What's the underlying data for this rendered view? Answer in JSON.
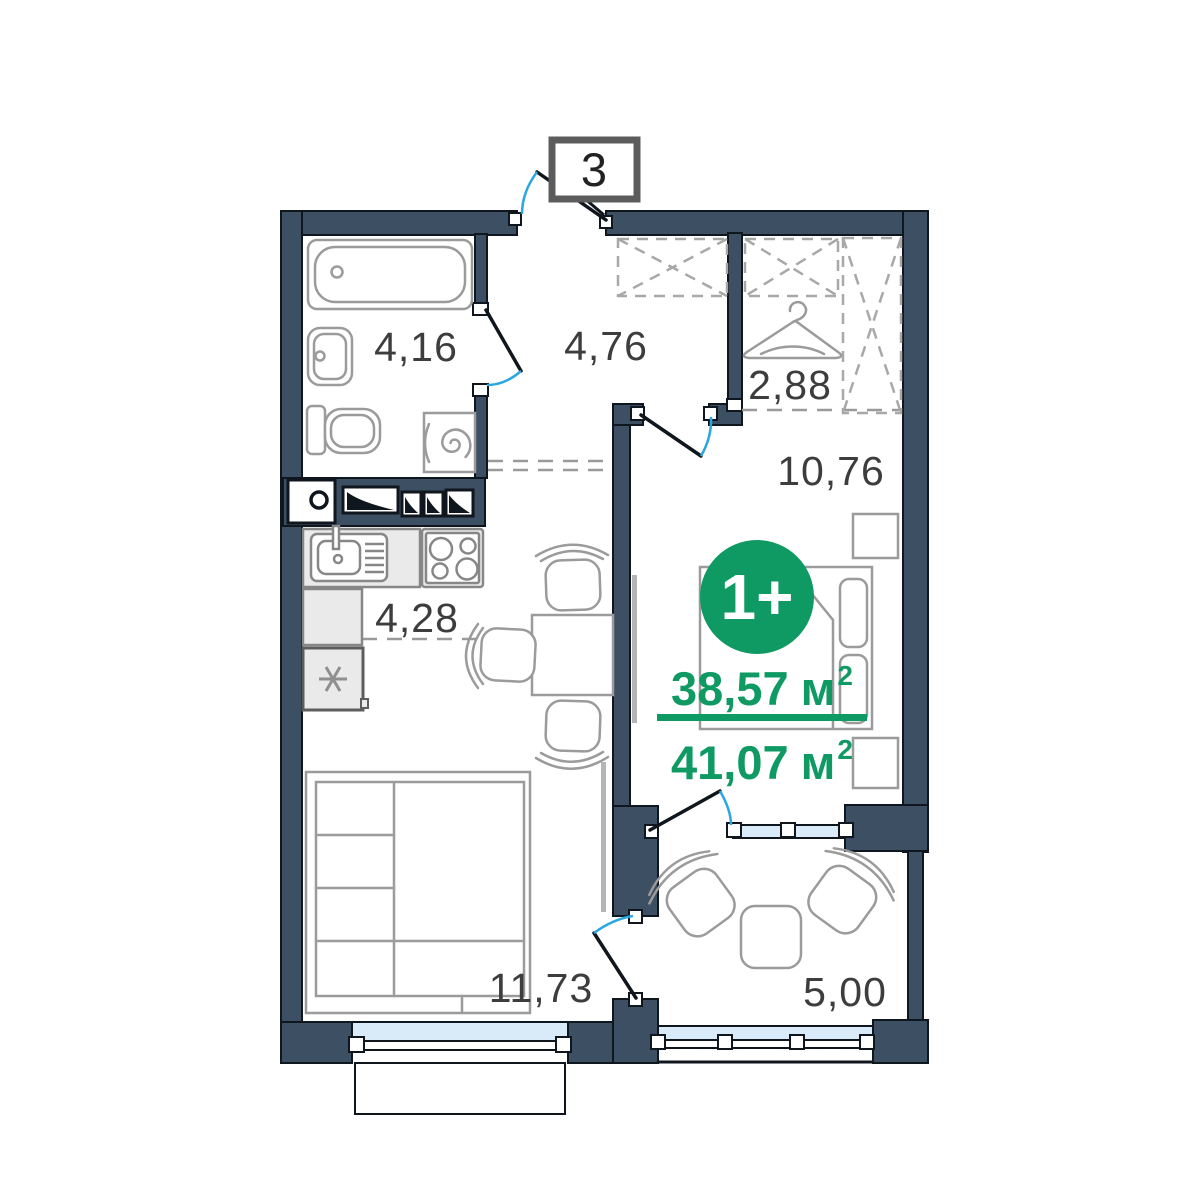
{
  "plan": {
    "entrance_label": "3",
    "type_badge": "1+",
    "area_main": "38,57",
    "area_total": "41,07",
    "area_unit": "м",
    "area_sup": "2",
    "rooms": {
      "bathroom": "4,16",
      "hallway": "4,76",
      "closet": "2,88",
      "bedroom": "10,76",
      "kitchen": "4,28",
      "living": "11,73",
      "balcony": "5,00"
    },
    "icons": [
      "bathtub",
      "bathroom-sink",
      "toilet",
      "washing-machine",
      "ventilation-shaft",
      "kitchen-sink",
      "stove",
      "fridge",
      "dining-table",
      "chair",
      "hanger",
      "wardrobe",
      "bed",
      "nightstand",
      "sofa",
      "armchair",
      "balcony-table",
      "window",
      "door-swing"
    ],
    "colors": {
      "wall": "#3d4f63",
      "accent_green": "#0f9a63",
      "window_glass": "#d9ebf9",
      "door_arc_blue": "#2aa7e3",
      "label_text": "#3d3d3d"
    }
  }
}
